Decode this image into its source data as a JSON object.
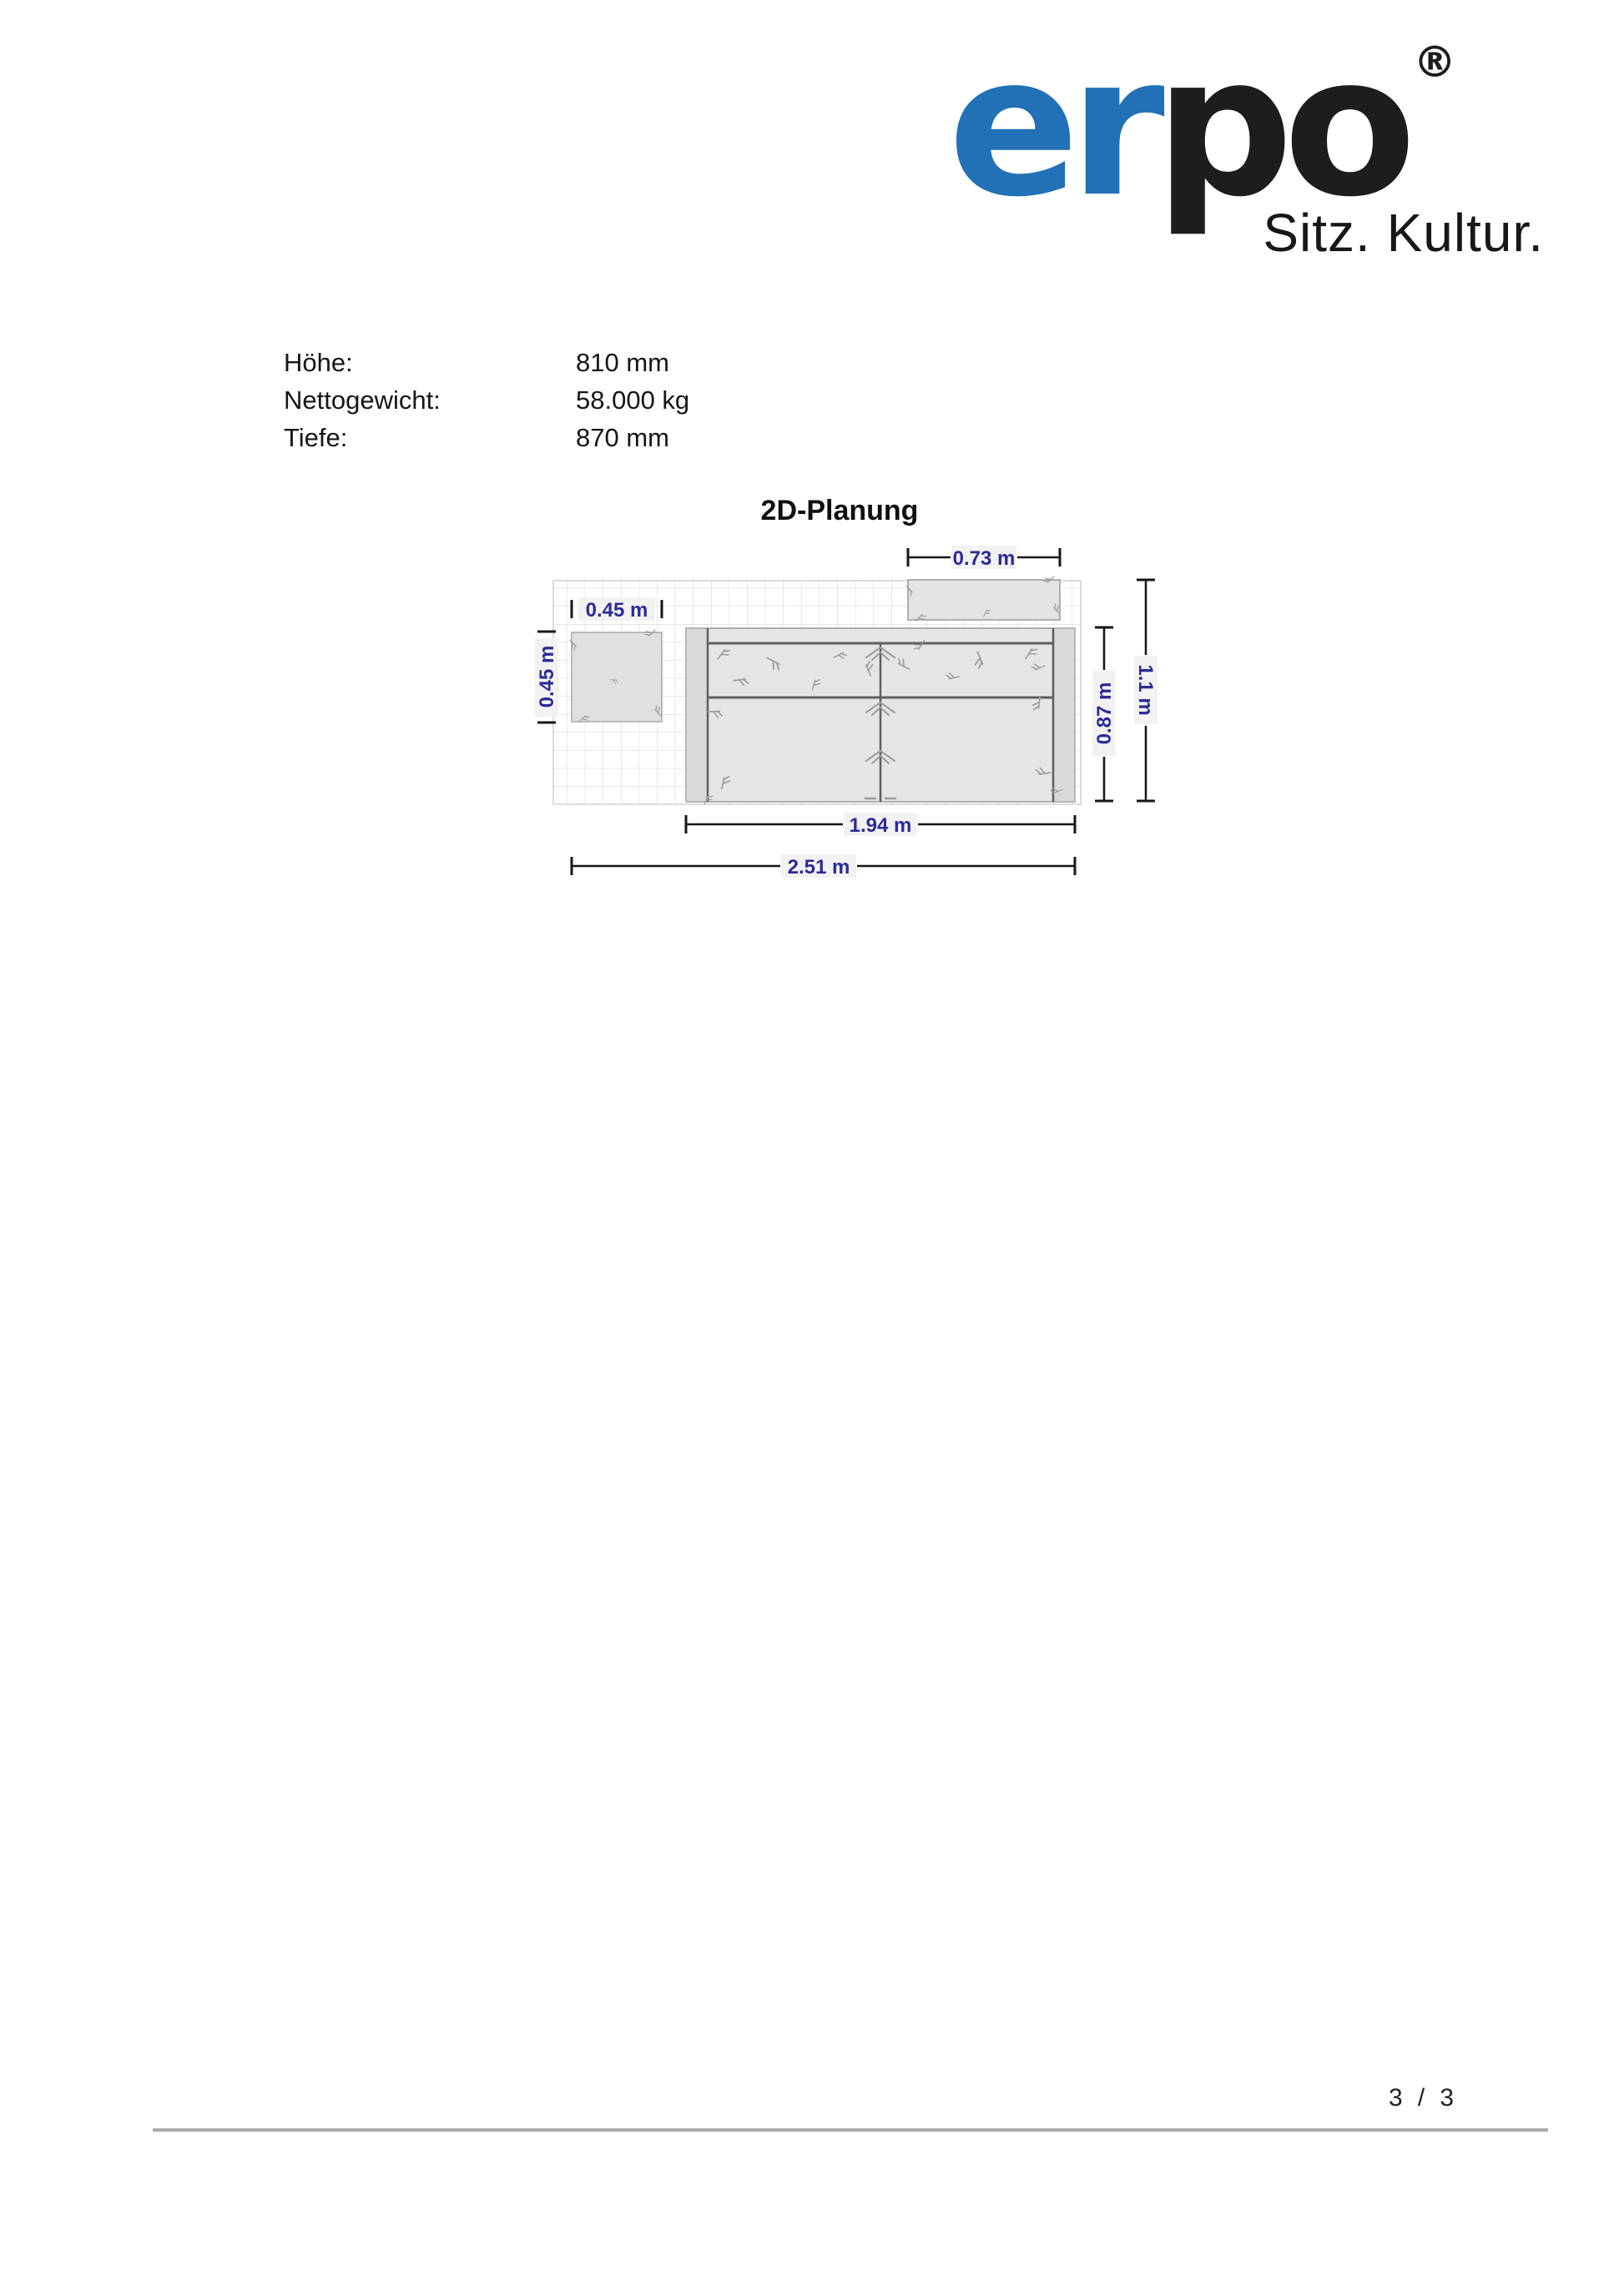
{
  "logo": {
    "brand_primary": "er",
    "brand_secondary": "po",
    "registered_mark": "®",
    "tagline": "Sitz. Kultur.",
    "brand_blue": "#2270b5",
    "brand_black": "#1d1d1b"
  },
  "specs": {
    "rows": [
      {
        "label": "Höhe:",
        "value": "810 mm"
      },
      {
        "label": "Nettogewicht:",
        "value": "58.000 kg"
      },
      {
        "label": "Tiefe:",
        "value": "870 mm"
      }
    ]
  },
  "plan": {
    "title": "2D-Planung",
    "dimensions": {
      "sideboard_width": "0.73 m",
      "stool_width": "0.45 m",
      "stool_depth": "0.45 m",
      "sofa_depth": "0.87 m",
      "total_depth": "1.1 m",
      "sofa_width": "1.94 m",
      "total_width": "2.51 m"
    },
    "colors": {
      "dimension_text": "#2b2b97",
      "dimension_line": "#161616",
      "furniture_fill": "#e5e5e5",
      "grid_line": "#cfcfcf"
    }
  },
  "footer": {
    "page_current": "3",
    "separator": "/",
    "page_total": "3"
  }
}
